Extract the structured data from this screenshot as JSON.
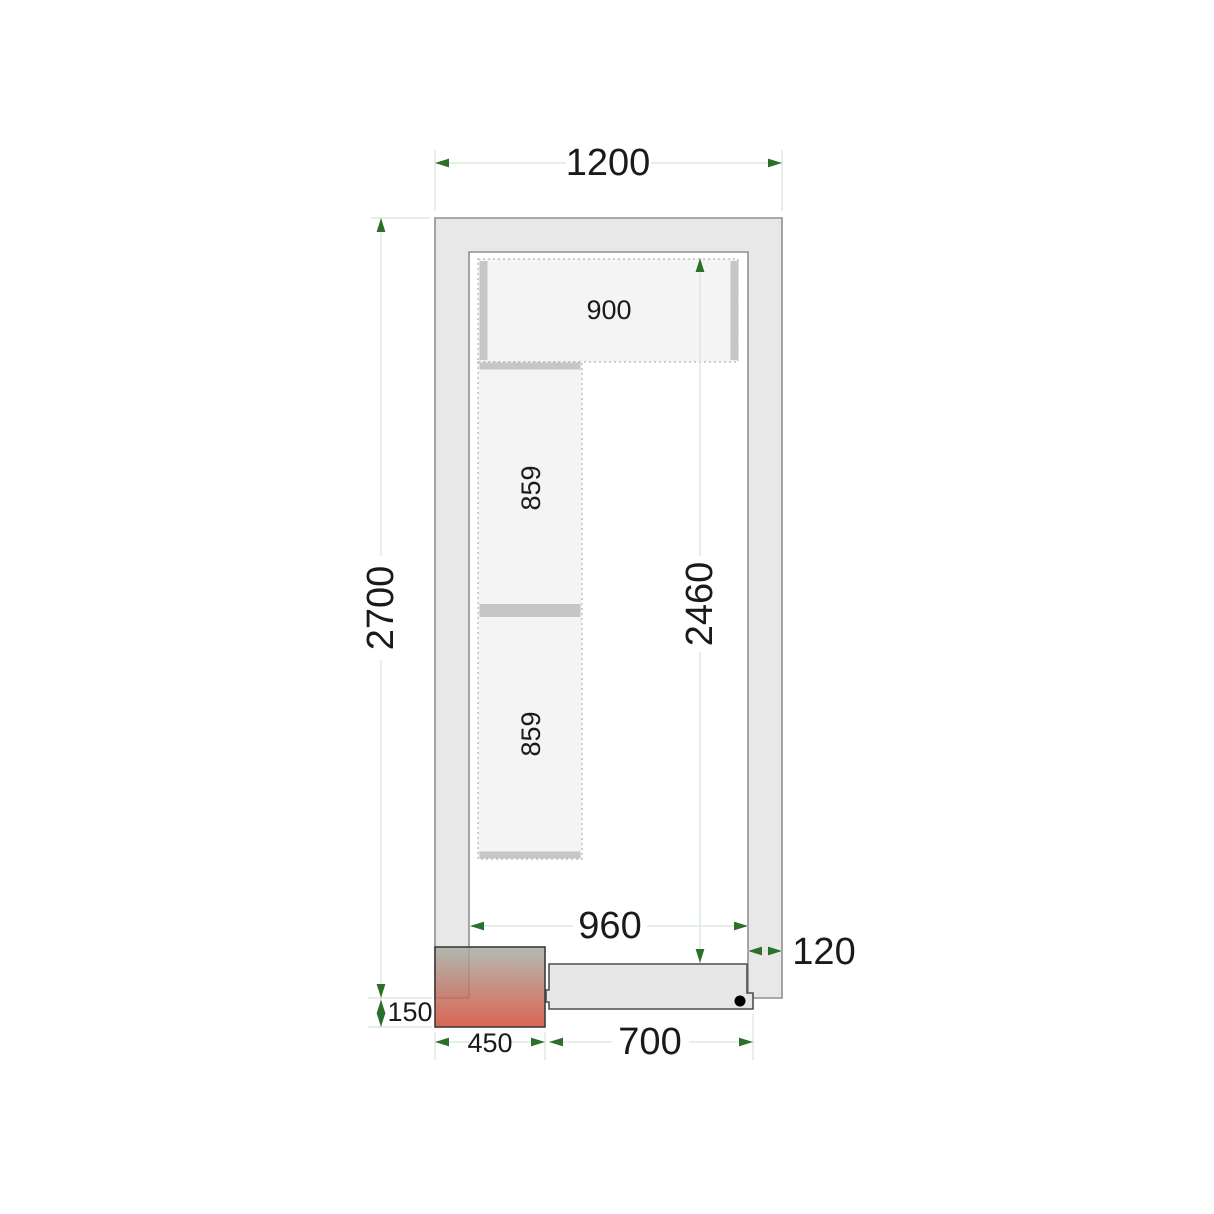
{
  "dims": {
    "total_width": "1200",
    "total_depth": "2700",
    "interior_depth": "2460",
    "interior_width": "960",
    "wall_thickness": "120",
    "door_width": "700",
    "unit_width": "450",
    "unit_depth": "150"
  },
  "shelves": {
    "top_shelf": "900",
    "left_shelf_upper": "859",
    "left_shelf_lower": "859"
  },
  "colors": {
    "wall_fill": "#e8e8e8",
    "wall_stroke": "#8f8f8f",
    "shelf_fill": "#f4f4f4",
    "shelf_dotted_stroke": "#b3b3b3",
    "shelf_support_fill": "#c6c6c6",
    "door_fill": "#e7e7e7",
    "door_stroke": "#4f4f4f",
    "handle_dot": "#000000",
    "dim_line": "#d5e5d5",
    "dim_arrow": "#2a6f2a",
    "label_text": "#1a1a1a",
    "unit_gradient_top": "#a8aea5",
    "unit_gradient_bottom": "#d24b36",
    "unit_stroke": "#3c3c3c"
  }
}
